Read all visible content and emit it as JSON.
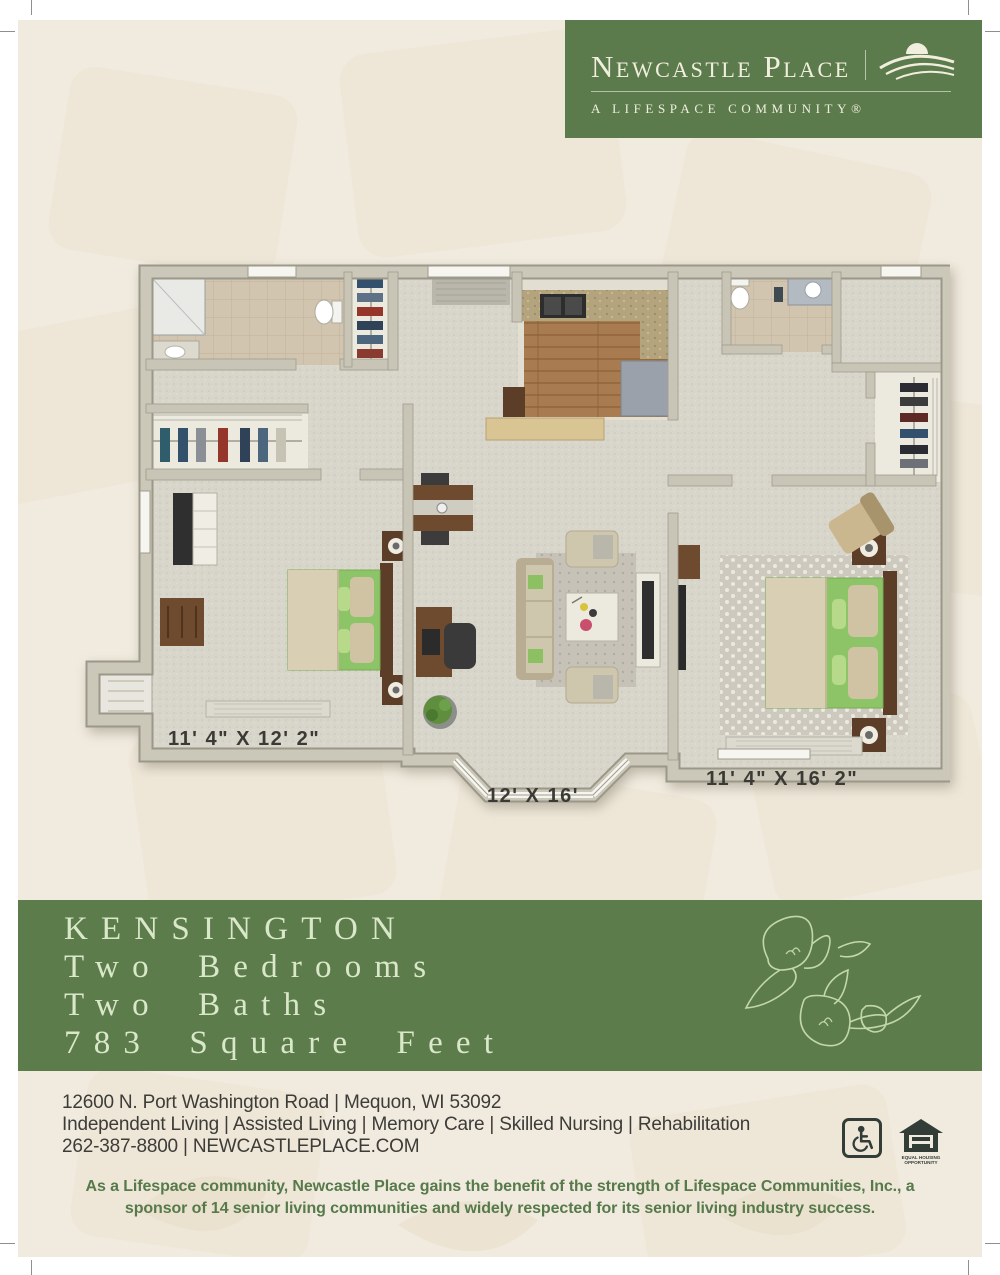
{
  "header": {
    "brand_name": "Newcastle Place",
    "tagline": "A LIFESPACE COMMUNITY®"
  },
  "floor_plan": {
    "description": "3D top-down floor plan of a two-bedroom, two-bath apartment",
    "dimensions": [
      {
        "room": "bedroom-1",
        "label": "11' 4\" X 12' 2\""
      },
      {
        "room": "living-room",
        "label": "12' X 16'"
      },
      {
        "room": "bedroom-2",
        "label": "11' 4\" X 16' 2\""
      }
    ]
  },
  "plan_banner": {
    "name": "KENSINGTON",
    "line2": "Two Bedrooms",
    "line3": "Two Baths",
    "line4": "783 Square Feet"
  },
  "footer": {
    "address": "12600 N. Port Washington Road | Mequon, WI 53092",
    "services": "Independent Living | Assisted Living | Memory Care | Skilled Nursing | Rehabilitation",
    "phone_web": "262-387-8800 | NEWCASTLEPLACE.COM",
    "equal_housing_caption_1": "EQUAL HOUSING",
    "equal_housing_caption_2": "OPPORTUNITY",
    "disclaimer_line1": "As a Lifespace community, Newcastle Place gains the benefit of the strength of Lifespace Communities, Inc., a",
    "disclaimer_line2": "sponsor of 14 senior living communities and widely respected for its senior living industry success."
  },
  "colors": {
    "brand_green": "#5b7b4c",
    "banner_green": "#5d7c4c",
    "page_cream": "#f1ebdf",
    "banner_text": "#d9e8c9",
    "body_text": "#3d3c38",
    "disclaimer_green": "#567a4a"
  }
}
